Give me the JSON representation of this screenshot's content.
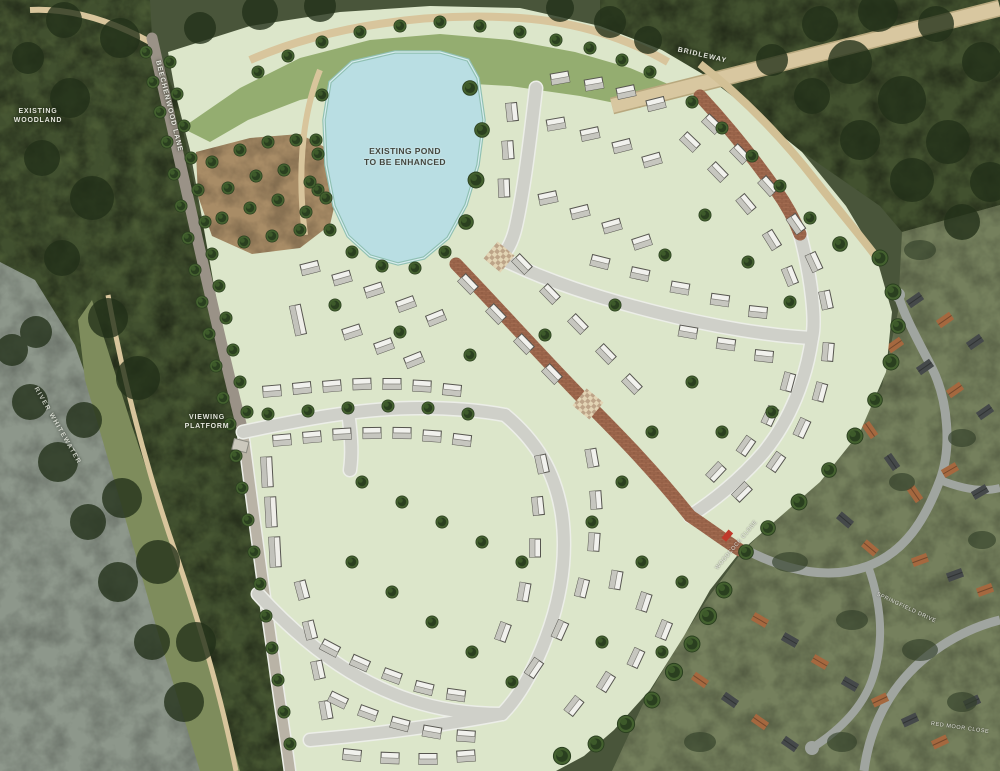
{
  "map": {
    "kind": "illustrative-housing-masterplan-over-aerial-photo",
    "labels": {
      "pond": [
        "EXISTING POND",
        "TO BE ENHANCED"
      ],
      "woodland": [
        "EXISTING",
        "WOODLAND"
      ],
      "viewing": [
        "VIEWING",
        "PLATFORM"
      ],
      "lane": "BEECHENWOOD LANE",
      "bridleway": "BRIDLEWAY",
      "river": "RIVER WHITEWATER",
      "street_ne": "WOODCOCK CLOSE",
      "street_e": "SPRINGFIELD DRIVE",
      "street_se": "RED MOOR CLOSE"
    },
    "colors": {
      "pond": "#b9dee3",
      "pond_edge": "#8fc0b2",
      "plot_green": "#dce6ca",
      "grass_band": "#94ad70",
      "road_grey": "#cfd0c9",
      "road_curb": "#eceee8",
      "brick_road": "#a26b50",
      "path_tan": "#d8c59c",
      "tree_dark": "#2a3f1f",
      "woodland": "#49553a",
      "water": "#8d978b",
      "field_green": "#7e8c5c",
      "aerial_estate_green": "#75805d",
      "aerial_road": "#a0a5a0",
      "roof_terracotta": "#a5683f",
      "roof_slate": "#45494a",
      "house_roof_light": "#f1f1ed",
      "house_roof_shade": "#c6c6bf",
      "accent_red": "#c0392b"
    }
  }
}
